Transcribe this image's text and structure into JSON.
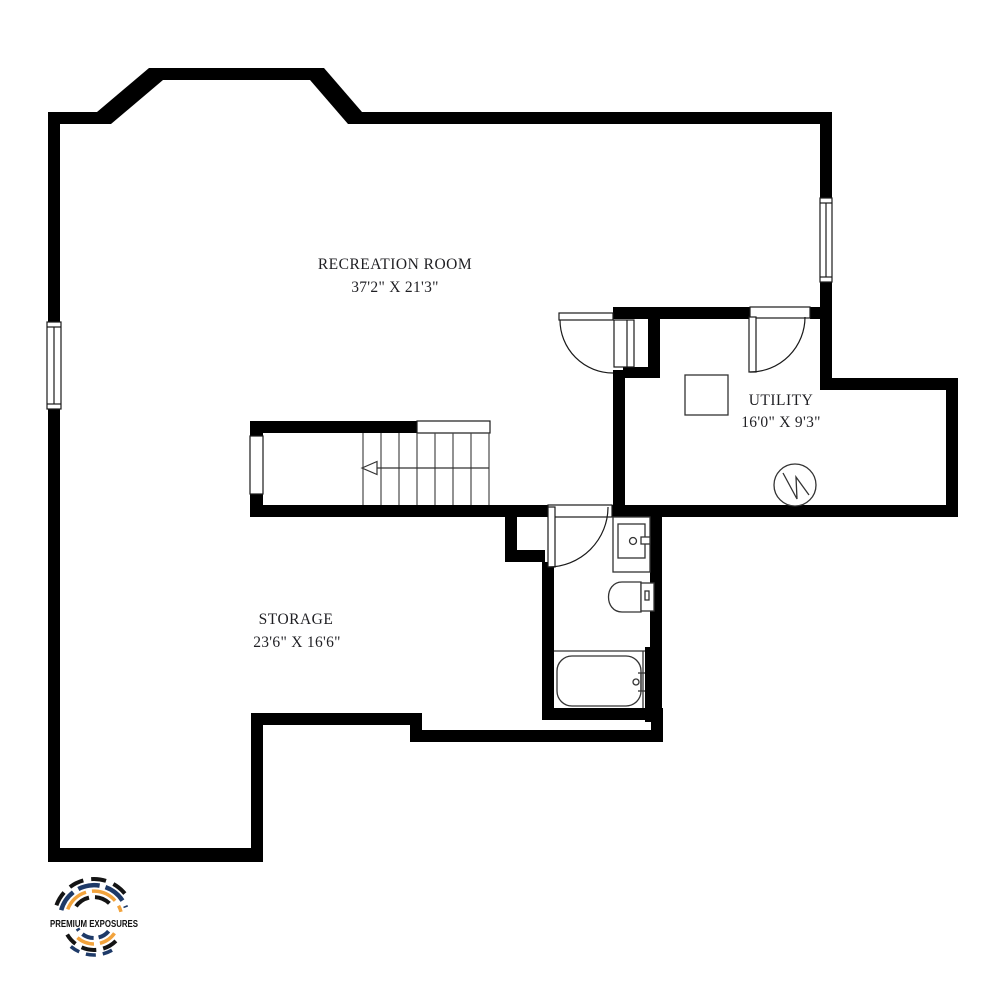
{
  "canvas": {
    "width": 991,
    "height": 1000,
    "background": "#ffffff"
  },
  "floorplan": {
    "wall_color": "#000000",
    "label_color": "#1f1f23",
    "rooms": [
      {
        "name": "RECREATION ROOM",
        "dimensions": "37'2\" X 21'3\""
      },
      {
        "name": "UTILITY",
        "dimensions": "16'0\" X 9'3\""
      },
      {
        "name": "STORAGE",
        "dimensions": "23'6\" X 16'6\""
      }
    ],
    "symbols": [
      "staircase-with-direction-arrow",
      "window-left-wall",
      "window-right-wall",
      "door-recreation-room-west",
      "door-recreation-to-utility",
      "door-bathroom",
      "sink-vanity",
      "toilet",
      "bathtub",
      "furnace",
      "water-heater"
    ]
  },
  "logo": {
    "text": "PREMIUM EXPOSURES",
    "colors": {
      "navy": "#1e3a68",
      "orange": "#f2a33c",
      "dark": "#141414"
    }
  }
}
